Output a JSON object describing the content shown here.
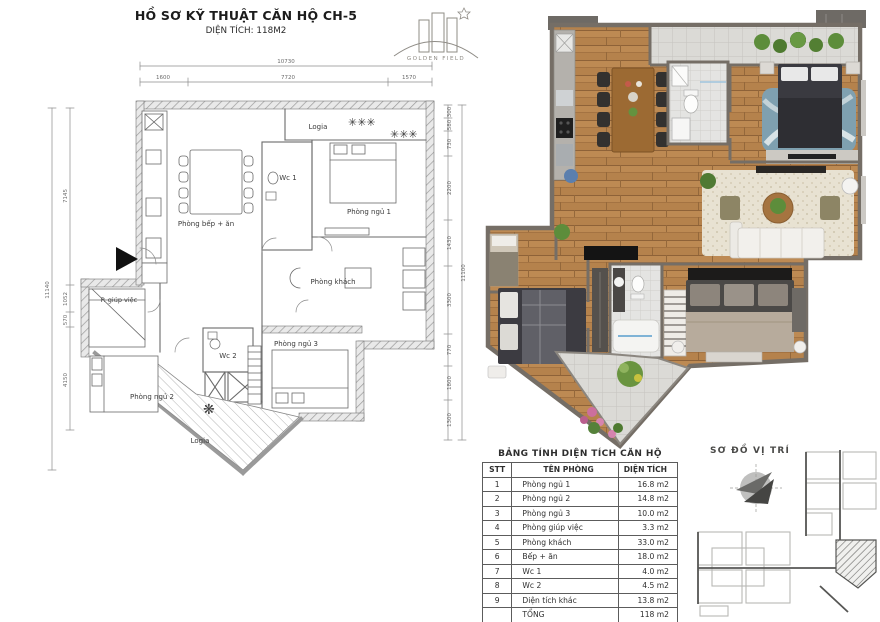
{
  "header": {
    "title": "HỒ SƠ KỸ THUẬT CĂN HỘ CH-5",
    "subtitle": "DIỆN TÍCH: 118M2"
  },
  "logo": {
    "text": "GOLDEN FIELD"
  },
  "tech_plan": {
    "labels": {
      "logia_top": "Logia",
      "kitchen": "Phòng bếp + ăn",
      "wc1": "Wc 1",
      "bedroom1": "Phòng ngủ 1",
      "living": "Phòng khách",
      "maid": "P. giúp việc",
      "bedroom2": "Phòng ngủ 2",
      "wc2": "Wc 2",
      "bedroom3": "Phòng ngủ 3",
      "logia_bottom": "Logia"
    },
    "decor": {
      "plants_top": "✳✳✳",
      "plants_top2": "✳✳✳",
      "plant_logia": "❋"
    },
    "dims": {
      "top_total": "10730",
      "top_seg1": "1600",
      "top_seg2": "7720",
      "top_seg3": "1570",
      "left_total": "11140",
      "left_seg1": "7145",
      "left_seg2": "1052",
      "left_seg3": "570",
      "left_seg4": "4150",
      "right_total": "11100",
      "right_seg1": "300",
      "right_seg2": "580",
      "right_seg3": "730",
      "right_seg4": "2200",
      "right_seg5": "1430",
      "right_seg6": "3300",
      "right_seg7": "770",
      "right_seg8": "1800",
      "right_seg9": "1300"
    }
  },
  "area_table": {
    "title": "BẢNG TÍNH DIỆN TÍCH CĂN HỘ",
    "columns": [
      "STT",
      "TÊN PHÒNG",
      "DIỆN TÍCH"
    ],
    "rows": [
      {
        "stt": "1",
        "name": "Phòng ngủ 1",
        "area": "16.8 m2"
      },
      {
        "stt": "2",
        "name": "Phòng ngủ 2",
        "area": "14.8 m2"
      },
      {
        "stt": "3",
        "name": "Phòng ngủ 3",
        "area": "10.0 m2"
      },
      {
        "stt": "4",
        "name": "Phòng giúp việc",
        "area": "3.3 m2"
      },
      {
        "stt": "5",
        "name": "Phòng khách",
        "area": "33.0 m2"
      },
      {
        "stt": "6",
        "name": "Bếp + ăn",
        "area": "18.0 m2"
      },
      {
        "stt": "7",
        "name": "Wc 1",
        "area": "4.0 m2"
      },
      {
        "stt": "8",
        "name": "Wc 2",
        "area": "4.5 m2"
      },
      {
        "stt": "9",
        "name": "Diện tích khác",
        "area": "13.8 m2"
      }
    ],
    "total": {
      "label": "TỔNG",
      "value": "118 m2"
    }
  },
  "location_plan": {
    "title": "SƠ ĐỒ VỊ TRÍ"
  },
  "colors": {
    "wood": "#b5824c",
    "wall": "#756e66",
    "tile": "#dbdad6",
    "plant": "#5d8d3b",
    "rug_blue": "#7fa0b0",
    "rug_cream": "#e8e2d2"
  }
}
